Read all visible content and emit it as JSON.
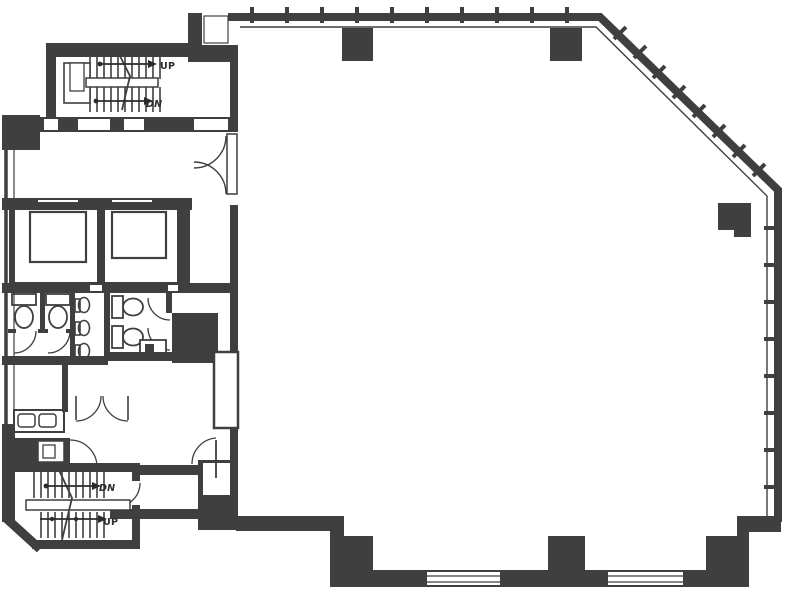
{
  "canvas": {
    "width": 787,
    "height": 601
  },
  "colors": {
    "background": "#ffffff",
    "wall": "#3f3f3f",
    "line": "#383838",
    "label": "#2b2b2b"
  },
  "north_stairwell": {
    "up_label": "UP",
    "down_label": "DN"
  },
  "south_stairwell": {
    "down_label": "DN",
    "up_label": "UP"
  },
  "features": {
    "elevators": 2,
    "toilet_stalls": 4,
    "urinals": 3,
    "sink_basins": 2,
    "structural_columns": 6,
    "perimeter_window_openings": 2
  }
}
